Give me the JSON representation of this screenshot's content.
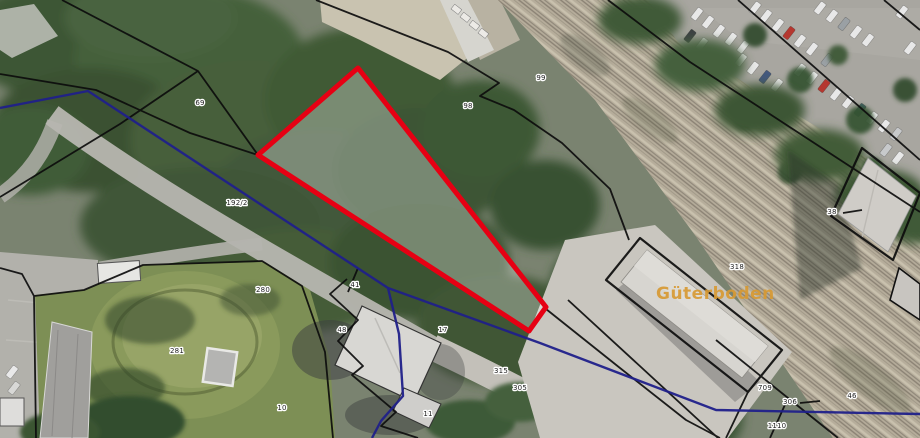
{
  "map": {
    "building_label": "Güterboden",
    "legend_colors": {
      "selected_parcel_outline": "#e60013",
      "municipal_boundary": "#20208a",
      "cadastral_parcel_lines": "#0d0d0d",
      "building_label_color": "#d79a33"
    },
    "selected_parcel": {
      "fill_opacity": 0.3,
      "vertices": "358,68 546,307 529,331 258,155"
    },
    "parcel_labels": [
      {
        "x": 200,
        "y": 105,
        "text": "69"
      },
      {
        "x": 237,
        "y": 205,
        "text": "192/2"
      },
      {
        "x": 263,
        "y": 292,
        "text": "280"
      },
      {
        "x": 177,
        "y": 353,
        "text": "281"
      },
      {
        "x": 282,
        "y": 410,
        "text": "10"
      },
      {
        "x": 355,
        "y": 287,
        "text": "41"
      },
      {
        "x": 342,
        "y": 332,
        "text": "48"
      },
      {
        "x": 443,
        "y": 332,
        "text": "17"
      },
      {
        "x": 501,
        "y": 373,
        "text": "315"
      },
      {
        "x": 520,
        "y": 390,
        "text": "305"
      },
      {
        "x": 468,
        "y": 108,
        "text": "98"
      },
      {
        "x": 541,
        "y": 80,
        "text": "99"
      },
      {
        "x": 832,
        "y": 214,
        "text": "38"
      },
      {
        "x": 737,
        "y": 269,
        "text": "318"
      },
      {
        "x": 765,
        "y": 390,
        "text": "709"
      },
      {
        "x": 790,
        "y": 404,
        "text": "306"
      },
      {
        "x": 777,
        "y": 428,
        "text": "1110"
      },
      {
        "x": 852,
        "y": 398,
        "text": "46"
      },
      {
        "x": 428,
        "y": 416,
        "text": "11"
      }
    ]
  }
}
